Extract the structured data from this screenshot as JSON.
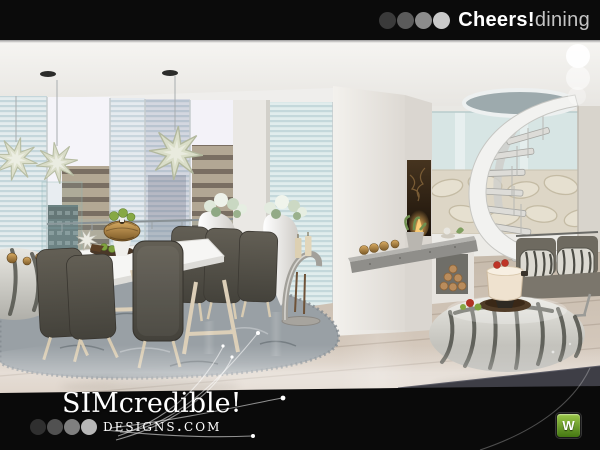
{
  "header": {
    "dot_colors": [
      "#3a3a3a",
      "#5b5b5b",
      "#8c8c8c",
      "#c9c9c9"
    ],
    "title_bold": "Cheers!",
    "title_light": "dining"
  },
  "side_dots": {
    "color": "#ffffff",
    "count": 3
  },
  "footer": {
    "brand_line1": "SIMcredible!",
    "brand_line2": "designs.com",
    "dot_colors": [
      "#2f2f2f",
      "#515151",
      "#7f7f7f",
      "#b7b7b7"
    ]
  },
  "watermark": {
    "label": "W",
    "bg_top": "#9cc84a",
    "bg_bottom": "#447712"
  },
  "scene": {
    "description": "Modern dining room render: white dining table with dark taupe high-back chairs on a gray shag rug, hanging paper stars, floor-to-ceiling windows with city view, white fireplace column with granite mantel and firewood niche, spiral staircase, zebra bench pillows and poufs, chocolate fondue set on pouf, glossy wood floor",
    "objects": [
      "hanging-star",
      "dining-table",
      "dining-chair",
      "shag-rug",
      "pedestal-vase",
      "fireplace-column",
      "mantel-candles",
      "firewood-niche",
      "candle-stand",
      "spiral-staircase",
      "bench-loveseat",
      "zebra-pillow",
      "zebra-pouf",
      "fondue-set",
      "city-window",
      "table-centerpiece"
    ]
  }
}
